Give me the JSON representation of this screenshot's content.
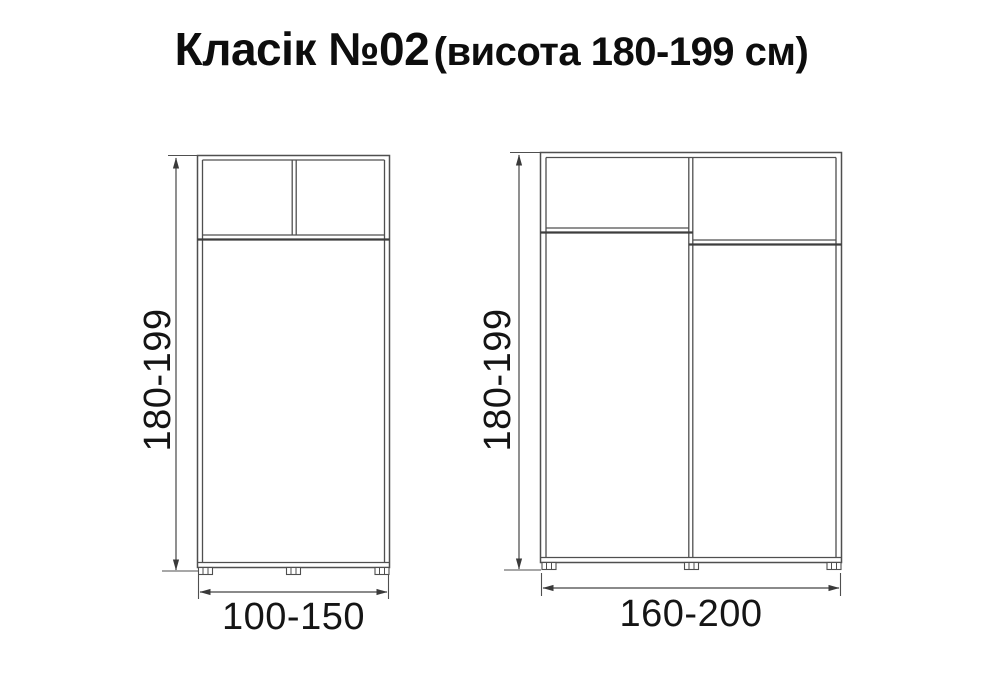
{
  "title": {
    "main": "Класік №02",
    "sub": "(висота 180-199 см)"
  },
  "wardrobes": [
    {
      "height_label": "180-199",
      "width_label": "100-150"
    },
    {
      "height_label": "180-199",
      "width_label": "160-200"
    }
  ],
  "colors": {
    "background": "#ffffff",
    "line": "#4f4f4f",
    "thick_line": "#3d3d3d",
    "text": "#151515",
    "title_text": "#0d0d0d"
  }
}
